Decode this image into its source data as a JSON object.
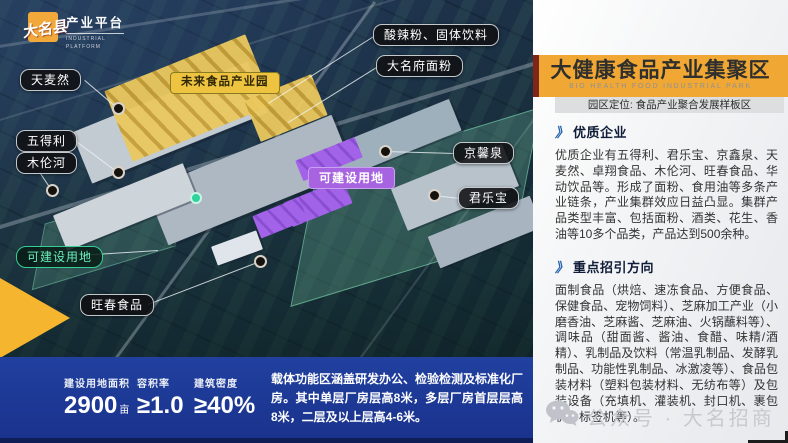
{
  "logo": {
    "county": "大名县",
    "platform": "产业平台",
    "platform_en": "INDUSTRIAL PLATFORM"
  },
  "map": {
    "labels": [
      {
        "id": "tianmairan",
        "text": "天麦然",
        "type": "dark"
      },
      {
        "id": "future-park",
        "text": "未来食品产业园",
        "type": "yellow"
      },
      {
        "id": "suanlafen",
        "text": "酸辣粉、固体饮料",
        "type": "dark"
      },
      {
        "id": "damingfu",
        "text": "大名府面粉",
        "type": "dark"
      },
      {
        "id": "wudeli",
        "text": "五得利",
        "type": "dark"
      },
      {
        "id": "mulunhe",
        "text": "木伦河",
        "type": "dark"
      },
      {
        "id": "jingxinquan",
        "text": "京馨泉",
        "type": "dark"
      },
      {
        "id": "buildable-purple",
        "text": "可建设用地",
        "type": "purple"
      },
      {
        "id": "junlebao",
        "text": "君乐宝",
        "type": "dark"
      },
      {
        "id": "buildable-green",
        "text": "可建设用地",
        "type": "green"
      },
      {
        "id": "wangchun",
        "text": "旺春食品",
        "type": "dark"
      }
    ]
  },
  "stats_bar": {
    "stats": [
      {
        "label": "建设用地面积",
        "value": "2900",
        "unit": "亩"
      },
      {
        "label": "容积率",
        "value": "≥1.0",
        "unit": ""
      },
      {
        "label": "建筑密度",
        "value": "≥40%",
        "unit": ""
      }
    ],
    "note": "载体功能区涵盖研发办公、检验检测及标准化厂房。其中单层厂房层高8米，多层厂房首层层高8米，二层及以上层高4-6米。"
  },
  "panel": {
    "title": "大健康食品产业集聚区",
    "title_en": "BIG HEALTH FOOD INDUSTRIAL PARK",
    "positioning": "园区定位: 食品产业聚合发展样板区",
    "sections": [
      {
        "heading": "优质企业",
        "body": "优质企业有五得利、君乐宝、京鑫泉、天麦然、卓翔食品、木伦河、旺春食品、华动饮品等。形成了面粉、食用油等多条产业链条，产业集群效应日益凸显。集群产品类型丰富、包括面粉、酒类、花生、香油等10多个品类，产品达到500余种。"
      },
      {
        "heading": "重点招引方向",
        "body": "面制食品（烘焙、速冻食品、方便食品、保健食品、宠物饲料）、芝麻加工产业（小磨香油、芝麻酱、芝麻油、火锅蘸料等）、调味品（甜面酱、酱油、食醋、味精/酒精）、乳制品及饮料（常温乳制品、发酵乳制品、功能性乳制品、冰激凌等）、食品包装材料（塑料包装材料、无纺布等）及包装设备（充填机、灌装机、封口机、裹包机、标签机等）。"
      }
    ],
    "footer": {
      "wechat": "公众号 · 大名招商"
    }
  },
  "icons": {
    "section_chevron": "》"
  },
  "colors": {
    "accent_yellow": "#F0A733",
    "bar_blue": "#1D3A9B",
    "purple": "#A763E0",
    "green": "#3ECF9A",
    "red_accent": "#7E2619",
    "chevron_blue": "#2462AA"
  }
}
